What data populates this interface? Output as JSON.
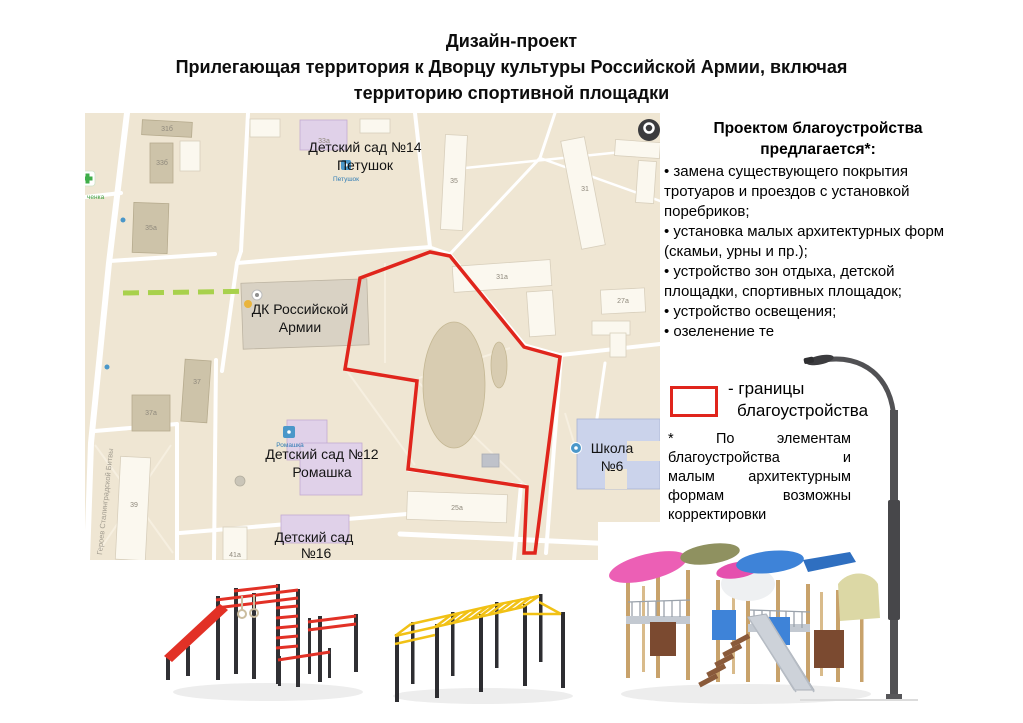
{
  "title": {
    "line1": "Дизайн-проект",
    "line2": "Прилегающая территория к Дворцу культуры Российской Армии, включая",
    "line3": "территорию спортивной площадки"
  },
  "proposals": {
    "heading_line1": "Проектом благоустройства",
    "heading_line2": "предлагается*:",
    "items": [
      "• замена существующего покрытия тротуаров и проездов с установкой поребриков;",
      "• установка малых архитектурных форм (скамьи, урны и пр.);",
      "• устройство зон отдыха, детской площадки, спортивных площадок;",
      "• устройство освещения;",
      "• озеленение те"
    ]
  },
  "legend": {
    "label_line1": "- границы",
    "label_line2": "благоустройства"
  },
  "footnote": {
    "line1": "* По элементам",
    "line2": "благоустройства и",
    "line3": "малым архитектурным",
    "line4": "формам возможны",
    "line5": "корректировки"
  },
  "map": {
    "labels": {
      "kindergarten14_line1": "Детский сад №14",
      "kindergarten14_line2": "Петушок",
      "petushok_poi": "Петушок",
      "dk_line1": "ДК Российской",
      "dk_line2": "Армии",
      "kindergarten12_line1": "Детский сад №12",
      "kindergarten12_line2": "Ромашка",
      "romashka_poi": "Ромашка",
      "kindergarten16_line1": "Детский сад",
      "kindergarten16_line2": "№16",
      "school6_line1": "Школа",
      "school6_line2": "№6",
      "street_name": "Героев Сталинградской Битвы",
      "green_poi": "ченка"
    },
    "building_numbers": [
      "31б",
      "33б",
      "35а",
      "33а",
      "35",
      "31",
      "31а",
      "27а",
      "25а",
      "37",
      "37а",
      "39",
      "41а"
    ]
  },
  "colors": {
    "boundary_red": "#e0251c",
    "map_beige": "#efe6d3",
    "kindergarten_purple": "#e0d1e9",
    "school_blue": "#cbd3eb",
    "green_strip": "#a8d14c",
    "poi_blue": "#4a97c9",
    "workout_red": "#e23126",
    "bars_yellow": "#f1c115"
  },
  "images": {
    "render1": "street-workout-complex",
    "render2": "yellow-monkey-bars-complex",
    "render3": "children-playground-complex",
    "render4": "street-lamp"
  }
}
